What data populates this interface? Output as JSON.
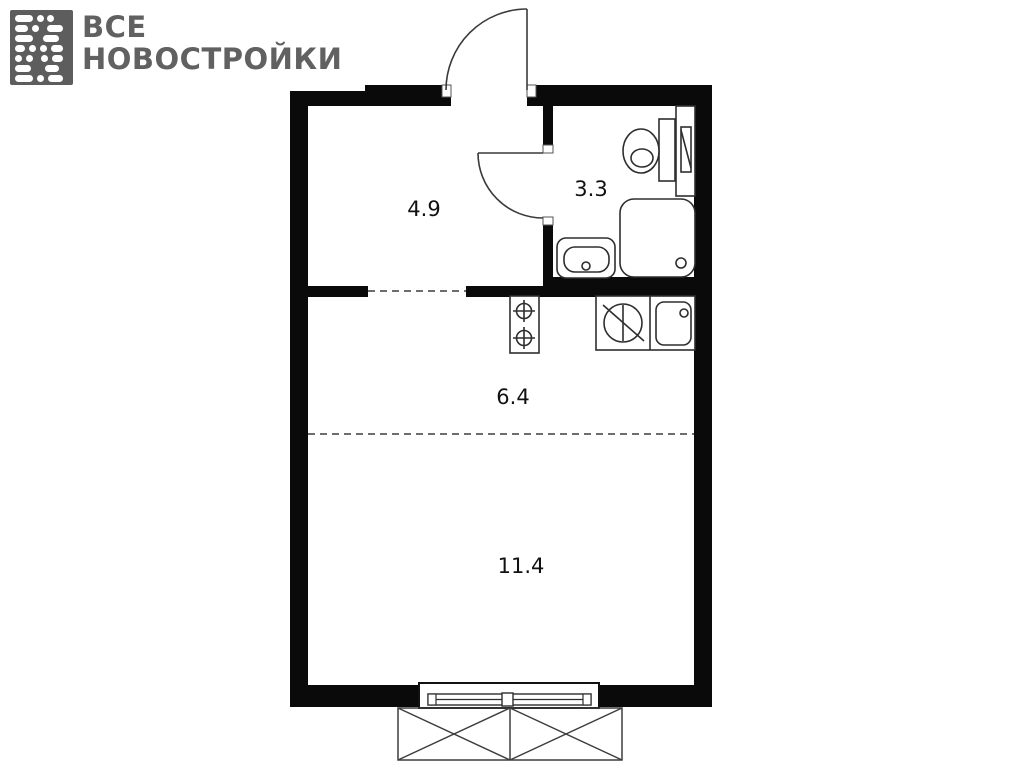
{
  "logo": {
    "line1": "ВСЕ",
    "line2": "НОВОСТРОЙКИ",
    "color": "#616161"
  },
  "plan": {
    "rooms": [
      {
        "id": "hallway",
        "area": "4.9"
      },
      {
        "id": "bathroom",
        "area": "3.3"
      },
      {
        "id": "kitchen",
        "area": "6.4"
      },
      {
        "id": "living-room",
        "area": "11.4"
      }
    ],
    "fixtures": [
      "entrance-door",
      "bathroom-door",
      "toilet",
      "vent-shaft",
      "shower-tray",
      "washbasin",
      "stove",
      "refrigerator",
      "kitchen-sink",
      "window",
      "balcony"
    ],
    "colors": {
      "wall": "#0a0a0a",
      "line": "#2e2e2e",
      "background": "#ffffff"
    }
  }
}
